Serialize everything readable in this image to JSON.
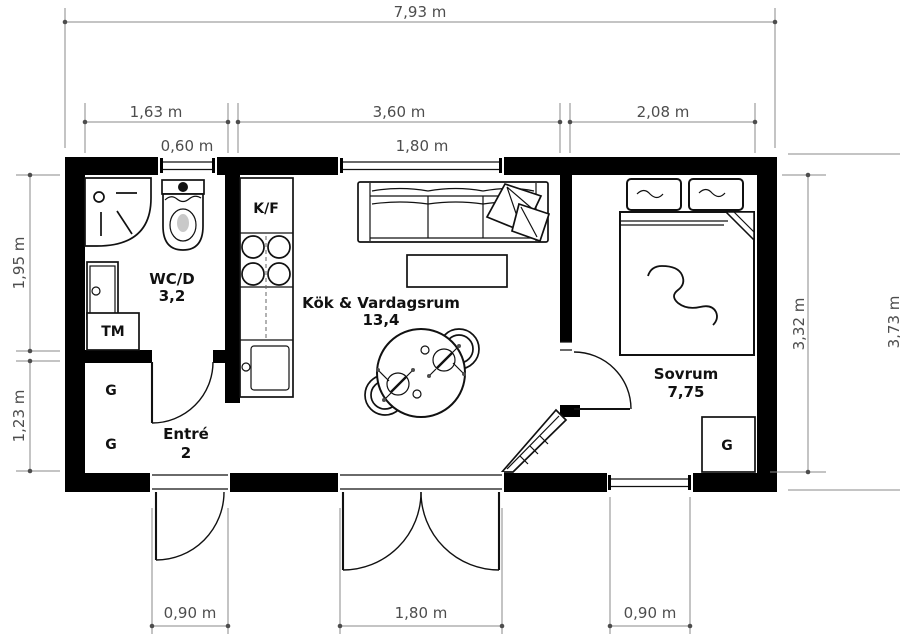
{
  "dims": {
    "overall_width": "7,93 m",
    "wc_section": "1,63 m",
    "living_section": "3,60 m",
    "bedroom_section": "2,08 m",
    "wc_window": "0,60 m",
    "living_window_top": "1,80 m",
    "wc_depth": "1,95 m",
    "entry_depth": "1,23 m",
    "interior_height": "3,32 m",
    "overall_height": "3,73 m",
    "entry_door": "0,90 m",
    "patio_door": "1,80 m",
    "bedroom_window": "0,90 m"
  },
  "rooms": {
    "wc": {
      "name": "WC/D",
      "area": "3,2"
    },
    "kitchen_living": {
      "name": "Kök & Vardagsrum",
      "area": "13,4"
    },
    "bedroom": {
      "name": "Sovrum",
      "area": "7,75"
    },
    "entry": {
      "name": "Entré",
      "area": "2"
    }
  },
  "appliances": {
    "washing_machine": "TM",
    "fridge_freezer": "K/F",
    "wardrobe": "G"
  },
  "colors": {
    "wall": "#000000",
    "furniture_line": "#111111",
    "dim_line": "#8a8a8a",
    "dim_text": "#4d4d4d",
    "label_text": "#111111",
    "toilet_shading": "#c9c9c9"
  }
}
